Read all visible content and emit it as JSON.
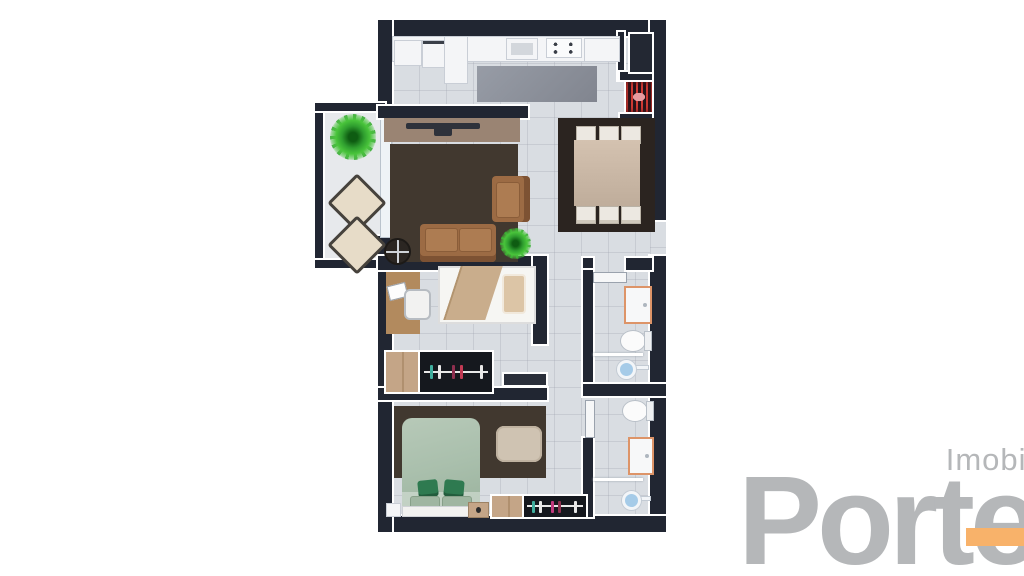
{
  "image_type": "3d-floor-plan-render",
  "logo": {
    "subtitle": "Imobiliária",
    "name": "Porte",
    "text_color": "#b5b7b9",
    "accent_color": "#f8b26a"
  },
  "palette": {
    "wall": "#212632",
    "floor_tile": "#d9dde2",
    "balcony_floor": "#e7e9ec",
    "living_rug": "#41382f",
    "dining_rug": "#2b2420",
    "kitchen_rug": "#8b909a",
    "sofa_brown": "#9c6b44",
    "tv_panel_wood": "#9a8473",
    "dining_table_wood": "#c7b5a3",
    "chair_white": "#ece8e1",
    "bed1_blanket": "#c9ad8c",
    "bed2_duvet": "#a9bfac",
    "bed2_pillow_green": "#2e7a50",
    "ottoman": "#cfc3b2",
    "desk_wood": "#b28a5e",
    "wardrobe_wood": "#c4a587",
    "wardrobe_interior": "#15181e",
    "bathroom_sink_trim": "#dd9468",
    "shower_head_blue": "#a5cbe8",
    "grill_coals_red": "#d03a34",
    "plant_green": "#2f9e2f"
  },
  "rooms": [
    {
      "name": "balcony",
      "items": [
        "potted-plant",
        "lounge-chair",
        "lounge-chair"
      ]
    },
    {
      "name": "living-room",
      "items": [
        "tv-panel",
        "tv",
        "area-rug",
        "sofa",
        "armchair",
        "coffee-table",
        "potted-plant"
      ]
    },
    {
      "name": "kitchen",
      "items": [
        "washer",
        "cabinet",
        "counter",
        "sink",
        "cooktop",
        "kitchen-rug",
        "refrigerator",
        "barbecue-grill"
      ]
    },
    {
      "name": "dining-area",
      "items": [
        "area-rug",
        "dining-table",
        "chair",
        "chair",
        "chair",
        "chair",
        "chair",
        "chair"
      ]
    },
    {
      "name": "bedroom-middle",
      "items": [
        "single-bed",
        "pillow",
        "desk",
        "laptop",
        "desk-chair",
        "wardrobe",
        "door"
      ]
    },
    {
      "name": "bathroom-top",
      "items": [
        "door",
        "vanity-sink",
        "toilet",
        "shower-partition",
        "shower-head"
      ]
    },
    {
      "name": "bathroom-bottom",
      "items": [
        "door",
        "toilet",
        "vanity-sink",
        "shower-partition",
        "shower-head"
      ]
    },
    {
      "name": "bedroom-bottom",
      "items": [
        "area-rug",
        "double-bed",
        "pillows",
        "ottoman",
        "nightstand",
        "nightstand",
        "wardrobe"
      ]
    },
    {
      "name": "hallway",
      "items": []
    },
    {
      "name": "entry",
      "items": [
        "door-opening"
      ]
    }
  ]
}
